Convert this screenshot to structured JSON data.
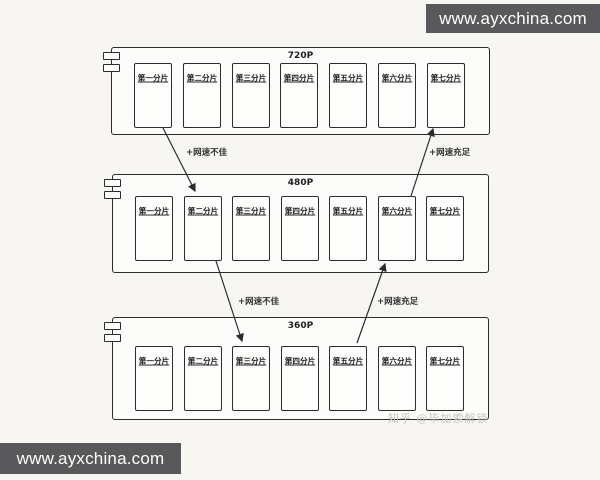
{
  "banners": {
    "top_text": "www.ayxchina.com",
    "bottom_text": "www.ayxchina.com"
  },
  "rows": [
    {
      "title": "720P",
      "segments": [
        "第一分片",
        "第二分片",
        "第三分片",
        "第四分片",
        "第五分片",
        "第六分片",
        "第七分片"
      ]
    },
    {
      "title": "480P",
      "segments": [
        "第一分片",
        "第二分片",
        "第三分片",
        "第四分片",
        "第五分片",
        "第六分片",
        "第七分片"
      ]
    },
    {
      "title": "360P",
      "segments": [
        "第一分片",
        "第二分片",
        "第三分片",
        "第四分片",
        "第五分片",
        "第六分片",
        "第七分片"
      ]
    }
  ],
  "arrows": [
    {
      "label": "+网速不佳",
      "from": "720P 第一分片",
      "to": "480P 第二分片",
      "direction": "down"
    },
    {
      "label": "+网速充足",
      "from": "480P 第六分片",
      "to": "720P 第七分片",
      "direction": "up"
    },
    {
      "label": "+网速不佳",
      "from": "480P 第二分片",
      "to": "360P 第三分片",
      "direction": "down"
    },
    {
      "label": "+网速充足",
      "from": "360P 第五分片",
      "to": "480P 第六分片",
      "direction": "up"
    }
  ],
  "watermark": {
    "text": "知乎 @毕加索解锁"
  },
  "colors": {
    "line": "#2c2c2c",
    "banner_bg": "#59595b",
    "banner_text": "#ffffff",
    "page_bg": "#f7f6f3",
    "watermark_text": "#c7c4c0"
  }
}
